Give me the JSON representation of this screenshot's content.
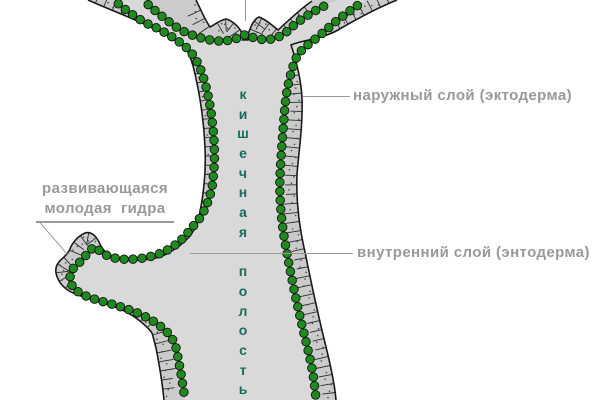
{
  "diagram": {
    "subject": "hydra-longitudinal-section",
    "labels": {
      "outer_layer": "наружный слой (эктодерма)",
      "inner_layer": "внутренний слой (энтодерма)",
      "bud_line1": "развивающаяся",
      "bud_line2": "молодая  гидра",
      "cavity_vertical": "кишечная полость"
    },
    "colors": {
      "ectoderm_band": "#cbcbcb",
      "cavity_fill": "#d9d9d9",
      "endoderm_green": "#1f8b1f",
      "outline_dark": "#1a1a1a",
      "cell_tick": "#2e2e2e",
      "cell_dot": "#4a4a4a",
      "leader_gray": "#999999",
      "cavity_text": "#1a6b5e"
    }
  }
}
